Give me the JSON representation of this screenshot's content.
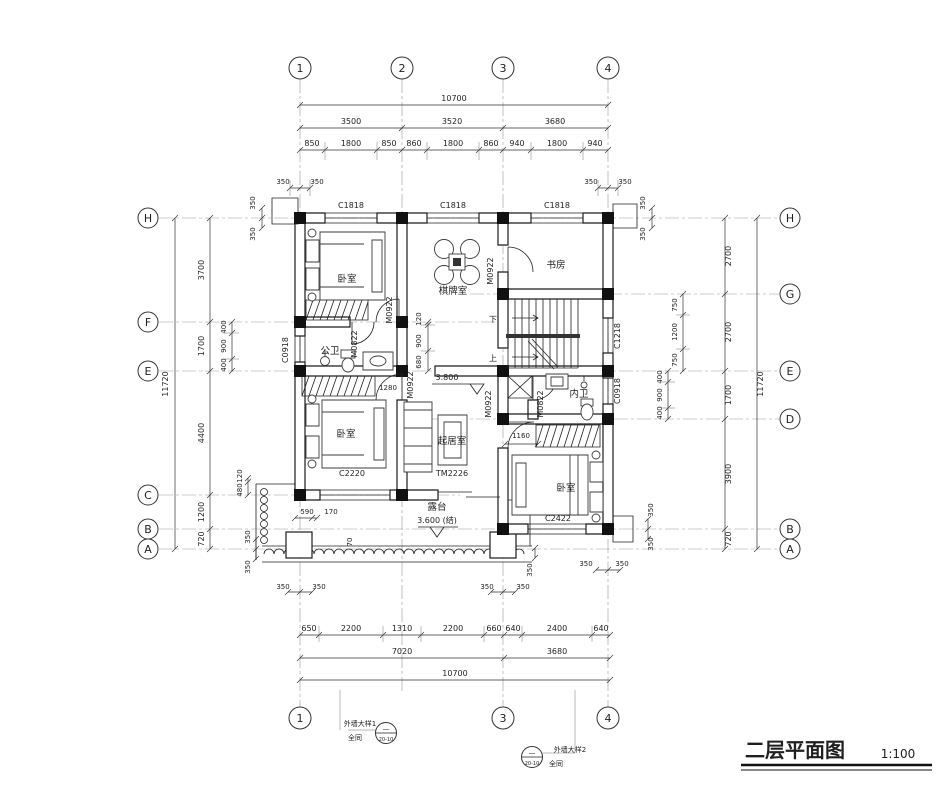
{
  "title": {
    "name": "二层平面图",
    "scale": "1:100"
  },
  "grid": {
    "cols": [
      "1",
      "2",
      "3",
      "4"
    ],
    "left_rows": [
      "H",
      "F",
      "E",
      "C",
      "B",
      "A"
    ],
    "right_rows": [
      "H",
      "G",
      "E",
      "D",
      "B",
      "A"
    ],
    "bottom_cols": [
      "1",
      "3",
      "4"
    ]
  },
  "rooms": {
    "bedroom": "卧室",
    "game_room": "棋牌室",
    "study": "书房",
    "public_bath": "公卫",
    "inner_bath": "内卫",
    "living": "起居室",
    "terrace": "露台"
  },
  "openings": {
    "c1818": "C1818",
    "c0918": "C0918",
    "c1218": "C1218",
    "c2220": "C2220",
    "c2422": "C2422",
    "m0922": "M0922",
    "m0822": "M0822",
    "tm2226": "TM2226"
  },
  "levels": {
    "floor": "3.800",
    "terrace": "3.600 (结)"
  },
  "stairs": {
    "down": "下",
    "up": "上"
  },
  "dims": {
    "top_total": "10700",
    "top_spans": [
      "3500",
      "3520",
      "3680"
    ],
    "top_subs": [
      "850",
      "1800",
      "850",
      "860",
      "1800",
      "860",
      "940",
      "1800",
      "940"
    ],
    "bottom_subs": [
      "650",
      "2200",
      "1310",
      "2200",
      "660",
      "640",
      "2400",
      "640"
    ],
    "bottom_spans": [
      "7020",
      "3680"
    ],
    "bottom_total": "10700",
    "left_total": "11720",
    "left_spans": [
      "3700",
      "1700",
      "4400",
      "1200",
      "720"
    ],
    "left_subs_fe": [
      "400",
      "900",
      "400"
    ],
    "left_subs_c": [
      "120",
      "480"
    ],
    "right_total": "11720",
    "right_spans": [
      "2700",
      "2700",
      "1700",
      "3900",
      "720"
    ],
    "right_subs_ge": [
      "750",
      "1200",
      "750"
    ],
    "right_subs_ed": [
      "400",
      "900",
      "400"
    ],
    "mid_subs": [
      "120",
      "900",
      "680"
    ],
    "wall_offset": "350",
    "terrace_edge": [
      "590",
      "170",
      "70"
    ],
    "closet_left": "1280",
    "closet_right": "1160"
  },
  "details": {
    "d1": {
      "label": "外墙大样1",
      "note": "全同",
      "ref": "20-10"
    },
    "d2": {
      "label": "外墙大样2",
      "note": "全同",
      "ref": "20-10"
    }
  }
}
